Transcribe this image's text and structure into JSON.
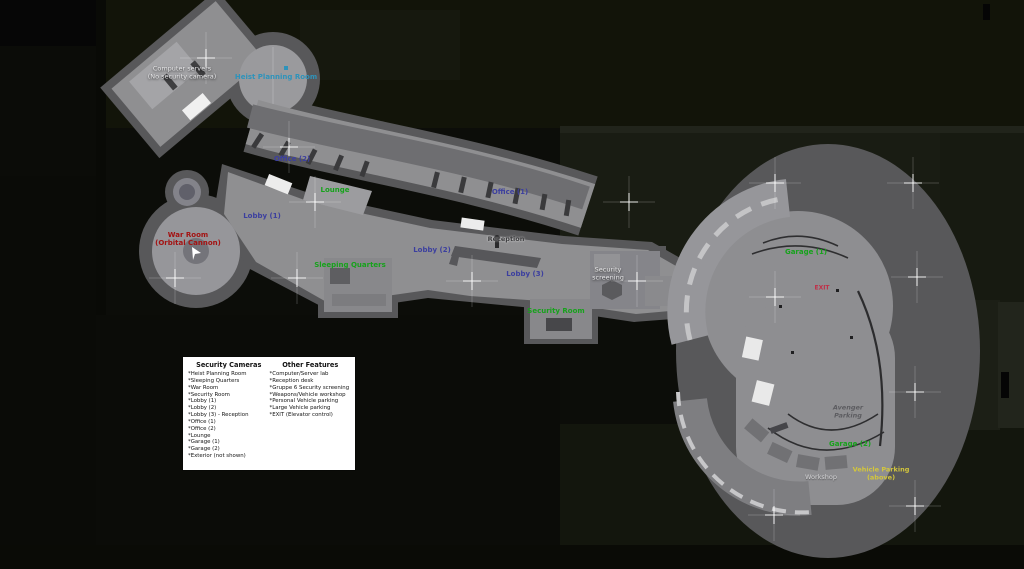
{
  "map": {
    "name": "Facility map",
    "labels": [
      {
        "id": "computer-servers",
        "lines": [
          "Computer servers",
          "(No security camera)"
        ]
      },
      {
        "id": "heist-planning-room",
        "lines": [
          "Heist Planning Room"
        ]
      },
      {
        "id": "office-2",
        "lines": [
          "Office (2)"
        ]
      },
      {
        "id": "lounge",
        "lines": [
          "Lounge"
        ]
      },
      {
        "id": "office-1",
        "lines": [
          "Office (1)"
        ]
      },
      {
        "id": "lobby-1",
        "lines": [
          "Lobby (1)"
        ]
      },
      {
        "id": "war-room",
        "lines": [
          "War Room",
          "(Orbital Cannon)"
        ]
      },
      {
        "id": "reception",
        "lines": [
          "Reception"
        ]
      },
      {
        "id": "lobby-2",
        "lines": [
          "Lobby (2)"
        ]
      },
      {
        "id": "sleeping-quarters",
        "lines": [
          "Sleeping Quarters"
        ]
      },
      {
        "id": "lobby-3",
        "lines": [
          "Lobby (3)"
        ]
      },
      {
        "id": "security-screening",
        "lines": [
          "Security",
          "screening"
        ]
      },
      {
        "id": "security-room",
        "lines": [
          "Security Room"
        ]
      },
      {
        "id": "garage-1",
        "lines": [
          "Garage (1)"
        ]
      },
      {
        "id": "exit",
        "lines": [
          "EXIT"
        ]
      },
      {
        "id": "avenger-parking",
        "lines": [
          "Avenger",
          "Parking"
        ]
      },
      {
        "id": "garage-2",
        "lines": [
          "Garage (2)"
        ]
      },
      {
        "id": "vehicle-parking",
        "lines": [
          "Vehicle Parking",
          "(above)"
        ]
      },
      {
        "id": "workshop",
        "lines": [
          "Workshop"
        ]
      }
    ],
    "legend": {
      "security_cameras": {
        "title": "Security Cameras",
        "items": [
          "*Heist Planning Room",
          "*Sleeping Quarters",
          "*War Room",
          "*Security Room",
          "*Lobby (1)",
          "*Lobby (2)",
          "*Lobby (3) - Reception",
          "*Office (1)",
          "*Office (2)",
          "*Lounge",
          "*Garage (1)",
          "*Garage (2)",
          "*Exterior (not shown)"
        ]
      },
      "other_features": {
        "title": "Other Features",
        "items": [
          "*Computer/Server lab",
          "*Reception desk",
          "*Gruppe 6 Security screening",
          "*Weapons/Vehicle workshop",
          "*Personal Vehicle parking",
          "*Large Vehicle parking",
          "*EXIT (Elevator control)"
        ]
      }
    },
    "colors": {
      "background": "#0c0d09",
      "wall_gray": "#58585a",
      "floor_gray": "#8f8f91",
      "label_blue": "#3c3f9f",
      "label_green": "#17a21c",
      "label_teal": "#2e93bb",
      "label_red": "#a31212",
      "label_exit_red": "#c03048",
      "label_yellow": "#d3c63c",
      "label_white": "#e6e6e8",
      "label_gray": "#5c5c60",
      "legend_bg": "#ffffff"
    }
  }
}
